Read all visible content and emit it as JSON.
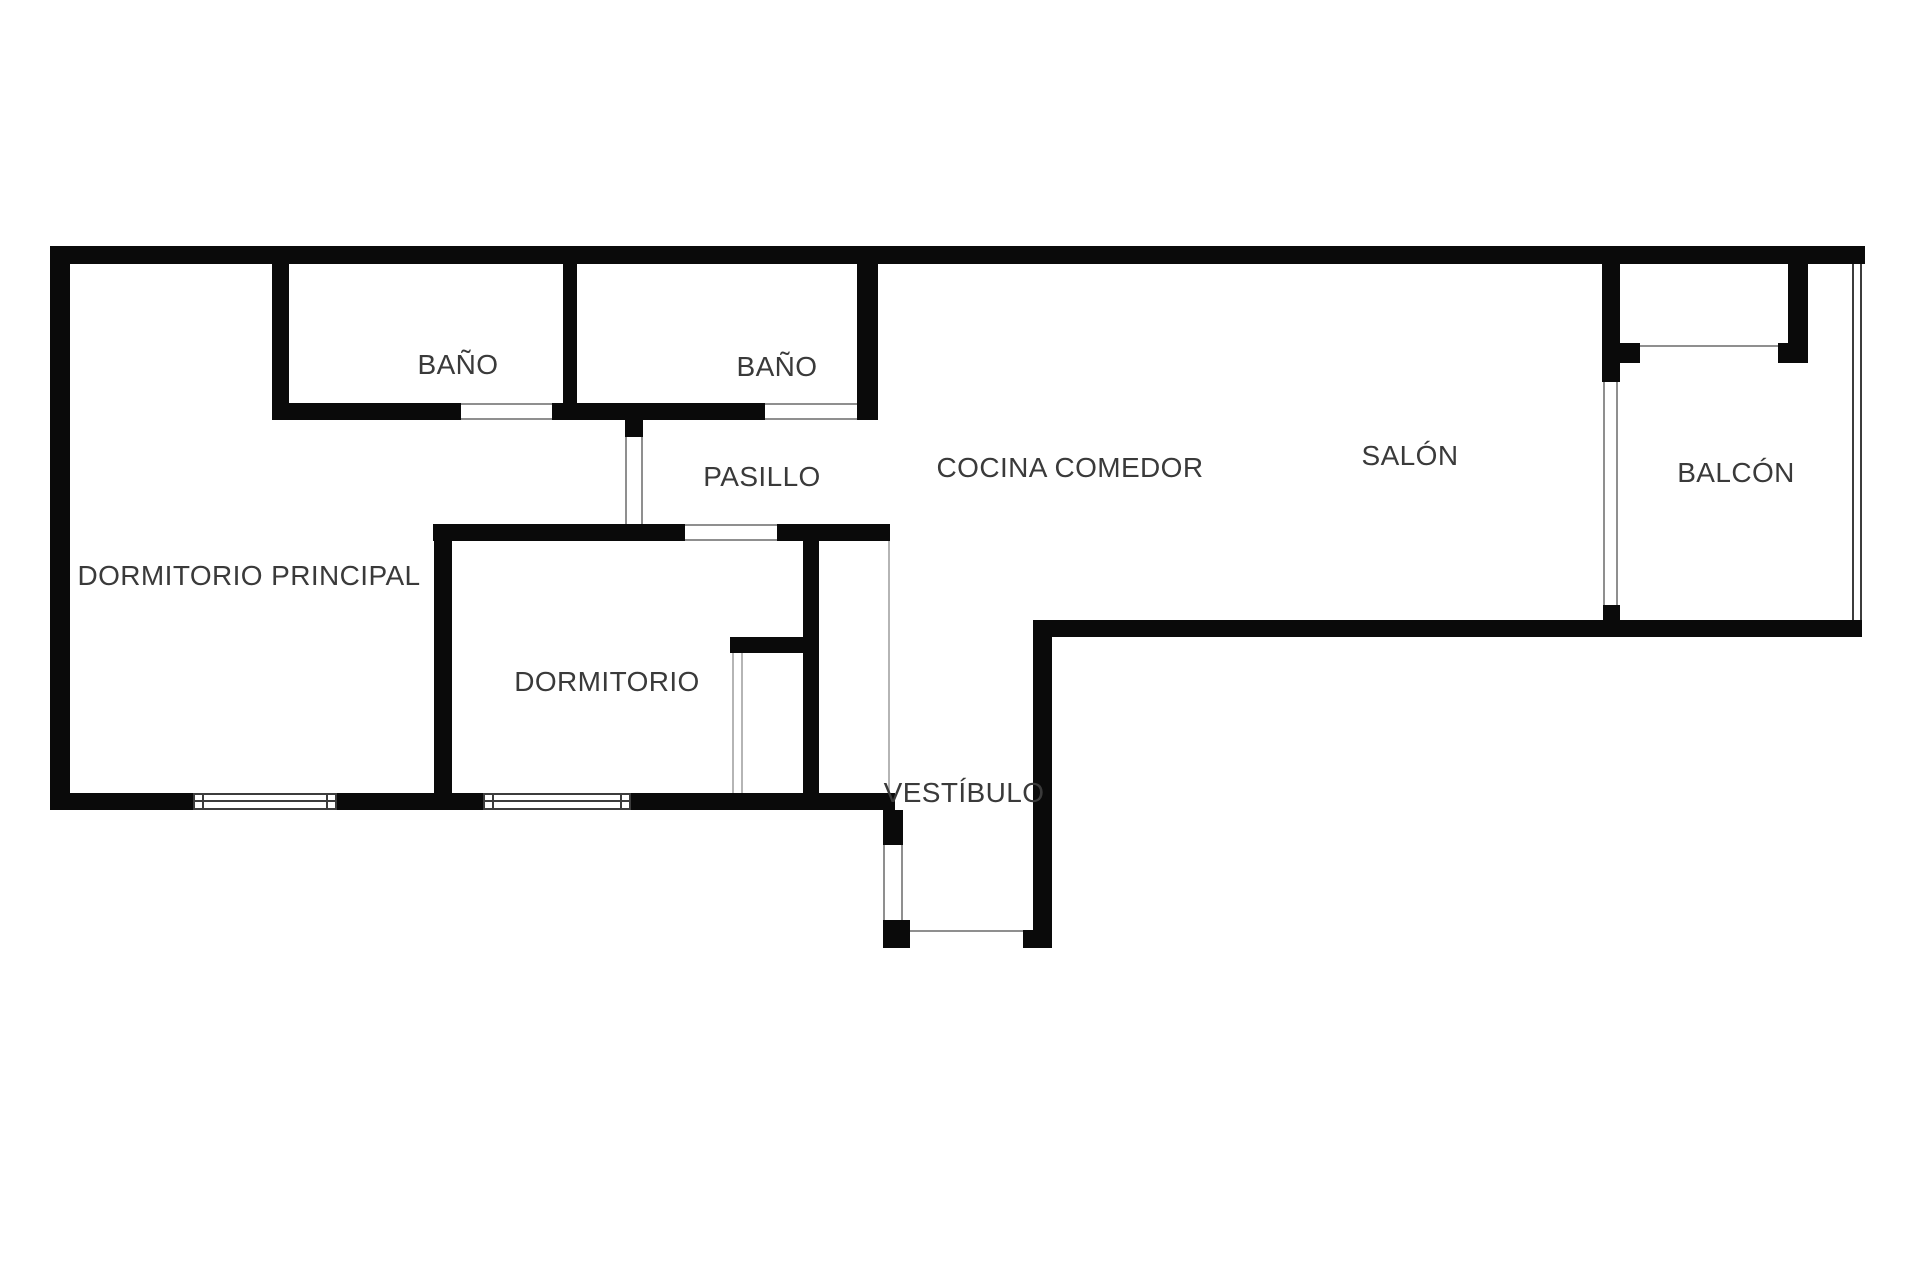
{
  "canvas": {
    "width": 1920,
    "height": 1280
  },
  "colors": {
    "background": "#ffffff",
    "wall": "#0a0a0a",
    "frame_dark": "#3c3c3c",
    "frame_light": "#8f8f8f",
    "frame_faint": "#b5b5b5",
    "label": "#3a3a3a"
  },
  "rooms": [
    {
      "id": "dormitorio-principal",
      "label": "DORMITORIO PRINCIPAL",
      "cx": 249,
      "cy": 576
    },
    {
      "id": "bano-1",
      "label": "BAÑO",
      "cx": 458,
      "cy": 365
    },
    {
      "id": "bano-2",
      "label": "BAÑO",
      "cx": 777,
      "cy": 367
    },
    {
      "id": "pasillo",
      "label": "PASILLO",
      "cx": 762,
      "cy": 477
    },
    {
      "id": "dormitorio",
      "label": "DORMITORIO",
      "cx": 607,
      "cy": 682
    },
    {
      "id": "cocina-comedor",
      "label": "COCINA COMEDOR",
      "cx": 1070,
      "cy": 468
    },
    {
      "id": "salon",
      "label": "SALÓN",
      "cx": 1410,
      "cy": 456
    },
    {
      "id": "balcon",
      "label": "BALCÓN",
      "cx": 1736,
      "cy": 473
    },
    {
      "id": "vestibulo",
      "label": "VESTÍBULO",
      "cx": 964,
      "cy": 793
    }
  ],
  "walls": [
    {
      "name": "wall-top",
      "x": 50,
      "y": 246,
      "w": 1815,
      "h": 18
    },
    {
      "name": "wall-left",
      "x": 50,
      "y": 264,
      "w": 20,
      "h": 546
    },
    {
      "name": "wall-bano1-left",
      "x": 272,
      "y": 264,
      "w": 17,
      "h": 156
    },
    {
      "name": "wall-bano-divider",
      "x": 563,
      "y": 264,
      "w": 14,
      "h": 139
    },
    {
      "name": "wall-bano2-right",
      "x": 857,
      "y": 264,
      "w": 21,
      "h": 156
    },
    {
      "name": "wall-bano1-bottom",
      "x": 272,
      "y": 403,
      "w": 189,
      "h": 17
    },
    {
      "name": "wall-banos-bottom-middle",
      "x": 552,
      "y": 403,
      "w": 213,
      "h": 17
    },
    {
      "name": "wall-pasillo-door-stub",
      "x": 625,
      "y": 415,
      "w": 18,
      "h": 22
    },
    {
      "name": "wall-dormitorio-top-left",
      "x": 433,
      "y": 524,
      "w": 252,
      "h": 17
    },
    {
      "name": "wall-dormitorio-top-right",
      "x": 777,
      "y": 524,
      "w": 113,
      "h": 17
    },
    {
      "name": "wall-dormitorio-divider",
      "x": 434,
      "y": 541,
      "w": 18,
      "h": 269
    },
    {
      "name": "wall-closet-divider",
      "x": 803,
      "y": 541,
      "w": 16,
      "h": 252
    },
    {
      "name": "wall-closet-stub",
      "x": 730,
      "y": 637,
      "w": 73,
      "h": 16
    },
    {
      "name": "wall-bedrooms-bottom-a",
      "x": 50,
      "y": 793,
      "w": 143,
      "h": 17
    },
    {
      "name": "wall-bedrooms-bottom-b",
      "x": 337,
      "y": 793,
      "w": 146,
      "h": 17
    },
    {
      "name": "wall-bedrooms-bottom-c",
      "x": 631,
      "y": 793,
      "w": 264,
      "h": 17
    },
    {
      "name": "wall-vestibulo-left-upper",
      "x": 883,
      "y": 810,
      "w": 20,
      "h": 35
    },
    {
      "name": "wall-vestibulo-left-lower",
      "x": 883,
      "y": 920,
      "w": 27,
      "h": 28
    },
    {
      "name": "wall-vestibulo-bottom-right",
      "x": 1023,
      "y": 930,
      "w": 29,
      "h": 18
    },
    {
      "name": "wall-vestibulo-right",
      "x": 1033,
      "y": 637,
      "w": 19,
      "h": 311
    },
    {
      "name": "wall-salon-bottom",
      "x": 1033,
      "y": 620,
      "w": 829,
      "h": 17
    },
    {
      "name": "wall-balcon-door-stub",
      "x": 1603,
      "y": 605,
      "w": 17,
      "h": 15
    },
    {
      "name": "wall-balcon-divider-top",
      "x": 1602,
      "y": 264,
      "w": 18,
      "h": 118
    },
    {
      "name": "wall-balcon-divider-stub",
      "x": 1620,
      "y": 343,
      "w": 20,
      "h": 20
    },
    {
      "name": "wall-balcon-right",
      "x": 1788,
      "y": 264,
      "w": 20,
      "h": 79
    },
    {
      "name": "wall-balcon-right-foot",
      "x": 1778,
      "y": 343,
      "w": 30,
      "h": 20
    }
  ],
  "openings": [
    {
      "name": "bano1-door-opening",
      "x": 461,
      "y": 403,
      "w": 91,
      "h": 17,
      "sides": "tb",
      "tone": "light"
    },
    {
      "name": "bano2-door-opening",
      "x": 765,
      "y": 403,
      "w": 92,
      "h": 17,
      "sides": "tb",
      "tone": "light"
    },
    {
      "name": "dormitorio-door-opening",
      "x": 685,
      "y": 524,
      "w": 92,
      "h": 17,
      "sides": "tb",
      "tone": "light"
    },
    {
      "name": "dormitorio-principal-door-opening",
      "x": 625,
      "y": 437,
      "w": 18,
      "h": 87,
      "sides": "lr",
      "tone": "light"
    },
    {
      "name": "vestibulo-side-opening",
      "x": 883,
      "y": 845,
      "w": 20,
      "h": 75,
      "sides": "lr",
      "tone": "light"
    },
    {
      "name": "entrance-opening",
      "x": 910,
      "y": 930,
      "w": 113,
      "h": 18,
      "sides": "t",
      "tone": "light"
    }
  ],
  "windows": [
    {
      "name": "window-dormitorio-principal",
      "x": 193,
      "y": 793,
      "w": 144,
      "h": 17
    },
    {
      "name": "window-dormitorio",
      "x": 483,
      "y": 793,
      "w": 148,
      "h": 17
    }
  ],
  "lines": [
    {
      "name": "balcon-sliding-door-line-left",
      "x": 1603,
      "y": 382,
      "w": 2,
      "h": 223,
      "tone": "light"
    },
    {
      "name": "balcon-sliding-door-line-right",
      "x": 1616,
      "y": 382,
      "w": 2,
      "h": 223,
      "tone": "light"
    },
    {
      "name": "balcon-window-sill-line",
      "x": 1640,
      "y": 345,
      "w": 138,
      "h": 2,
      "tone": "light"
    },
    {
      "name": "balcon-glazing-line-outer",
      "x": 1860,
      "y": 264,
      "w": 2,
      "h": 356,
      "tone": "dark"
    },
    {
      "name": "balcon-glazing-line-inner",
      "x": 1852,
      "y": 264,
      "w": 2,
      "h": 356,
      "tone": "dark"
    },
    {
      "name": "vestibulo-closet-front-line",
      "x": 888,
      "y": 541,
      "w": 2,
      "h": 251,
      "tone": "faint"
    },
    {
      "name": "dormitorio-closet-front-line-a",
      "x": 732,
      "y": 653,
      "w": 2,
      "h": 140,
      "tone": "faint"
    },
    {
      "name": "dormitorio-closet-front-line-b",
      "x": 741,
      "y": 653,
      "w": 2,
      "h": 140,
      "tone": "faint"
    }
  ]
}
